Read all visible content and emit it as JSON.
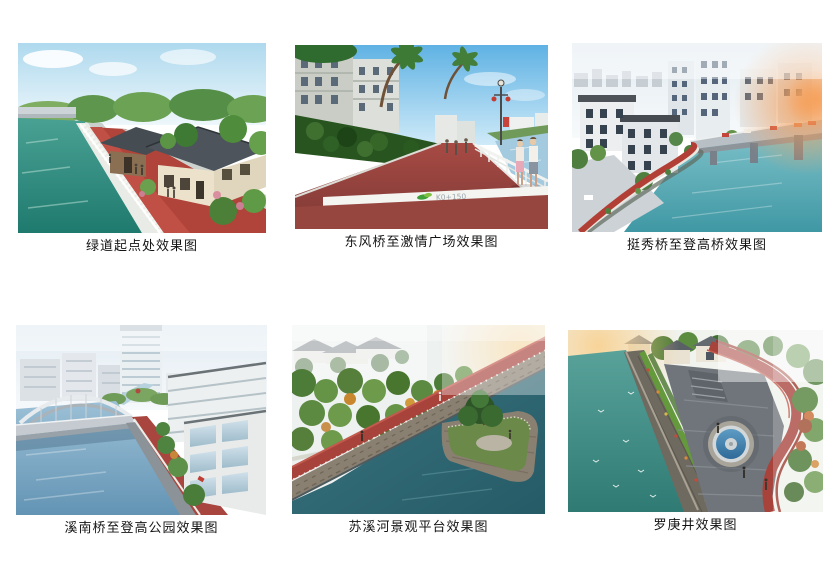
{
  "page": {
    "kind": "greenway-renderings-sheet"
  },
  "colors": {
    "greenway_red": "#a8433c",
    "water_teal": "#2f8f85",
    "water_blue": "#7aa6c2",
    "water_dark_teal": "#2d6471",
    "sky_blue": "#8fc8e8",
    "caption_text": "#141414",
    "page_background": "#ffffff"
  },
  "figures": [
    {
      "id": "greenway-start",
      "caption": "绿道起点处效果图"
    },
    {
      "id": "dongfeng-bridge-plaza",
      "caption": "东风桥至激情广场效果图",
      "marker_text": "K0+150"
    },
    {
      "id": "tingxiu-denggao-bridge",
      "caption": "挺秀桥至登高桥效果图"
    },
    {
      "id": "xinan-bridge-denggao-park",
      "caption": "溪南桥至登高公园效果图"
    },
    {
      "id": "suxi-river-platform",
      "caption": "苏溪河景观平台效果图"
    },
    {
      "id": "luogeng-well",
      "caption": "罗庚井效果图"
    }
  ]
}
